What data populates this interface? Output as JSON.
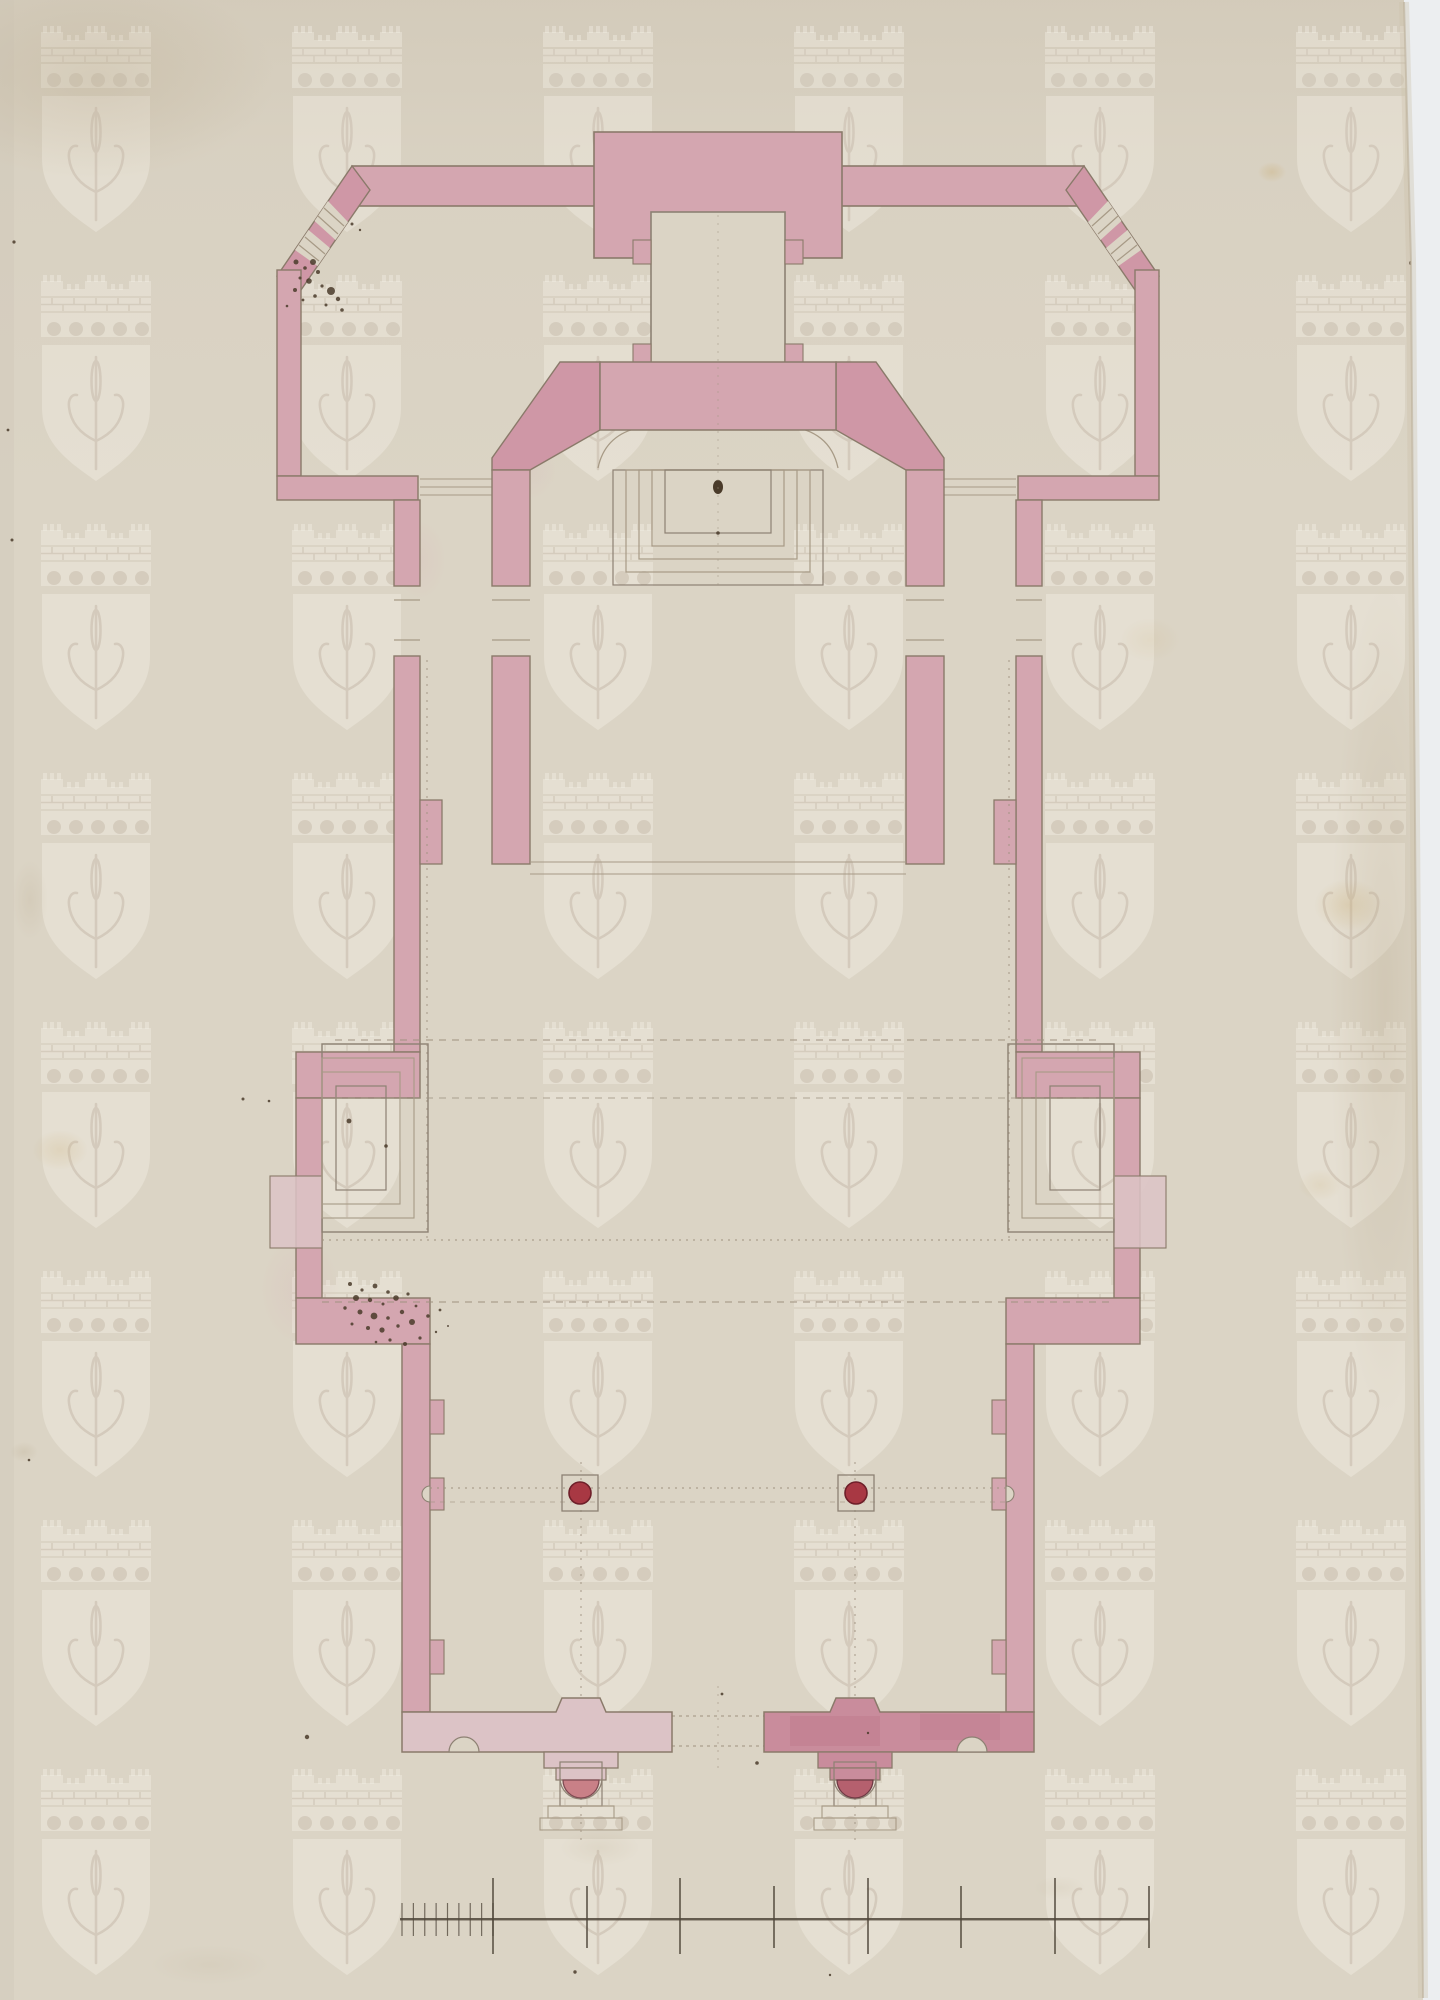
{
  "artwork": {
    "kind": "scanned architectural drawing",
    "subject": "longitudinal church floor plan drawn in pink watercolour wash on aged laid paper",
    "orientation": "portrait",
    "visible_text": "none",
    "features": [
      "rectangular apse block with inner sacristy room",
      "two chamfered octagonal corner pavilions joined by straight wings",
      "chancel with rounded interior corners and stepped altar platform",
      "long nave with shallow side chapel bays of concentric rectangles",
      "vestibule with two free-standing round columns",
      "entrance wall with semicircular niches and two projecting porches with half-round column bases",
      "graphic scale bar near the bottom edge",
      "repeating papermaker watermark of a mural crown above a shield bearing a halberd",
      "ink spatter clusters and foxing stains on the paper"
    ]
  },
  "palette": {
    "paper": "#dbd4c5",
    "paper-line": "#d3cabb",
    "white-margin": "#eceef0",
    "wall-pink": "#d4a6b0",
    "wall-pink-deep": "#cf97a6",
    "wall-pink-light": "#dcc3c6",
    "wall-pink-dark": "#c98c9c",
    "wall-outline": "#8a7a6a",
    "line-grey": "#8d8173",
    "line-light": "#a79a86",
    "dash": "#9f9381",
    "column-red": "#a83843",
    "column-ring": "#6e1f29",
    "porch-col-left": "#c98087",
    "porch-col-right": "#b5606e",
    "ink": "#4a3b2a",
    "wm-light": "#fbf8ef"
  },
  "watermark": {
    "motif": "mural crown with crenellated towers, brick band and arcade, above a heater shield charged with a halberd",
    "tile_width": 251,
    "tile_height": 249,
    "offset_x": 41,
    "offset_y": 14,
    "opacity": 0.32
  },
  "plan_axis_x": 718,
  "columns": {
    "cy": 1493,
    "r": 11,
    "base_size": 36,
    "cx_list": [
      580,
      856
    ]
  },
  "scale_bar": {
    "y": 1919,
    "x_start": 400,
    "x_end": 1149,
    "major_ticks": [
      493,
      587,
      680,
      774,
      868,
      961,
      1055,
      1149
    ],
    "major_tick_top": 1878,
    "major_tick_bottom": 1954,
    "minor_from": 402,
    "minor_to": 493,
    "minor_count": 8,
    "minor_top": 1903,
    "minor_bottom": 1936
  },
  "speckles": [
    [
      296,
      262,
      2.5
    ],
    [
      305,
      268,
      1.8
    ],
    [
      313,
      262,
      3.0
    ],
    [
      318,
      272,
      2.0
    ],
    [
      300,
      278,
      1.5
    ],
    [
      309,
      281,
      2.8
    ],
    [
      322,
      286,
      1.6
    ],
    [
      295,
      290,
      2.0
    ],
    [
      331,
      291,
      4.0
    ],
    [
      315,
      296,
      1.8
    ],
    [
      303,
      300,
      1.4
    ],
    [
      338,
      299,
      2.2
    ],
    [
      326,
      305,
      1.5
    ],
    [
      342,
      310,
      1.8
    ],
    [
      287,
      306,
      1.3
    ],
    [
      352,
      224,
      1.5
    ],
    [
      360,
      230,
      1.2
    ],
    [
      350,
      1284,
      2.0
    ],
    [
      362,
      1290,
      1.6
    ],
    [
      375,
      1286,
      2.4
    ],
    [
      388,
      1292,
      1.8
    ],
    [
      356,
      1298,
      3.0
    ],
    [
      370,
      1300,
      2.2
    ],
    [
      383,
      1304,
      1.5
    ],
    [
      396,
      1298,
      2.8
    ],
    [
      408,
      1294,
      1.6
    ],
    [
      345,
      1308,
      1.7
    ],
    [
      360,
      1312,
      2.5
    ],
    [
      374,
      1316,
      3.4
    ],
    [
      388,
      1318,
      1.8
    ],
    [
      402,
      1312,
      2.2
    ],
    [
      416,
      1306,
      1.4
    ],
    [
      352,
      1324,
      1.5
    ],
    [
      368,
      1328,
      2.0
    ],
    [
      382,
      1330,
      2.6
    ],
    [
      398,
      1326,
      1.7
    ],
    [
      412,
      1322,
      3.0
    ],
    [
      428,
      1316,
      1.8
    ],
    [
      440,
      1310,
      1.4
    ],
    [
      390,
      1340,
      1.6
    ],
    [
      405,
      1344,
      2.0
    ],
    [
      376,
      1342,
      1.3
    ],
    [
      420,
      1338,
      1.6
    ],
    [
      436,
      1332,
      1.2
    ],
    [
      448,
      1326,
      1.0
    ],
    [
      243,
      1099,
      1.5
    ],
    [
      269,
      1101,
      1.3
    ],
    [
      349,
      1121,
      2.4
    ],
    [
      386,
      1146,
      1.8
    ],
    [
      307,
      1737,
      2.2
    ],
    [
      757,
      1763,
      1.8
    ],
    [
      722,
      1694,
      1.4
    ],
    [
      1411,
      263,
      2.0
    ],
    [
      868,
      1733,
      1.2
    ],
    [
      14,
      242,
      1.6
    ],
    [
      8,
      430,
      1.4
    ],
    [
      12,
      540,
      1.5
    ],
    [
      29,
      1460,
      1.3
    ],
    [
      718,
      533,
      1.8
    ],
    [
      575,
      1972,
      1.7
    ],
    [
      830,
      1975,
      1.2
    ]
  ],
  "stains": [
    {
      "x": 95,
      "y": 78,
      "rx": 180,
      "ry": 100,
      "type": "brown",
      "op": 0.5
    },
    {
      "x": 1385,
      "y": 1000,
      "rx": 55,
      "ry": 420,
      "type": "brown",
      "op": 0.45
    },
    {
      "x": 1348,
      "y": 905,
      "rx": 34,
      "ry": 26,
      "type": "yellow",
      "op": 0.5
    },
    {
      "x": 1272,
      "y": 172,
      "rx": 14,
      "ry": 10,
      "type": "yellow",
      "op": 0.6
    },
    {
      "x": 60,
      "y": 1150,
      "rx": 28,
      "ry": 20,
      "type": "yellow",
      "op": 0.4
    },
    {
      "x": 24,
      "y": 1452,
      "rx": 14,
      "ry": 10,
      "type": "brown",
      "op": 0.4
    },
    {
      "x": 600,
      "y": 1848,
      "rx": 40,
      "ry": 18,
      "type": "brown",
      "op": 0.25
    },
    {
      "x": 1060,
      "y": 1888,
      "rx": 26,
      "ry": 12,
      "type": "brown",
      "op": 0.2
    },
    {
      "x": 210,
      "y": 1965,
      "rx": 60,
      "ry": 20,
      "type": "brown",
      "op": 0.2
    },
    {
      "x": 1320,
      "y": 1185,
      "rx": 22,
      "ry": 16,
      "type": "yellow",
      "op": 0.3
    },
    {
      "x": 30,
      "y": 900,
      "rx": 18,
      "ry": 40,
      "type": "brown",
      "op": 0.3
    },
    {
      "x": 1150,
      "y": 640,
      "rx": 30,
      "ry": 22,
      "type": "yellow",
      "op": 0.22
    },
    {
      "x": 420,
      "y": 560,
      "rx": 26,
      "ry": 40,
      "type": "pink",
      "op": 0.3
    },
    {
      "x": 300,
      "y": 1290,
      "rx": 40,
      "ry": 55,
      "type": "pink",
      "op": 0.35
    },
    {
      "x": 530,
      "y": 470,
      "rx": 26,
      "ry": 30,
      "type": "pink",
      "op": 0.28
    }
  ]
}
